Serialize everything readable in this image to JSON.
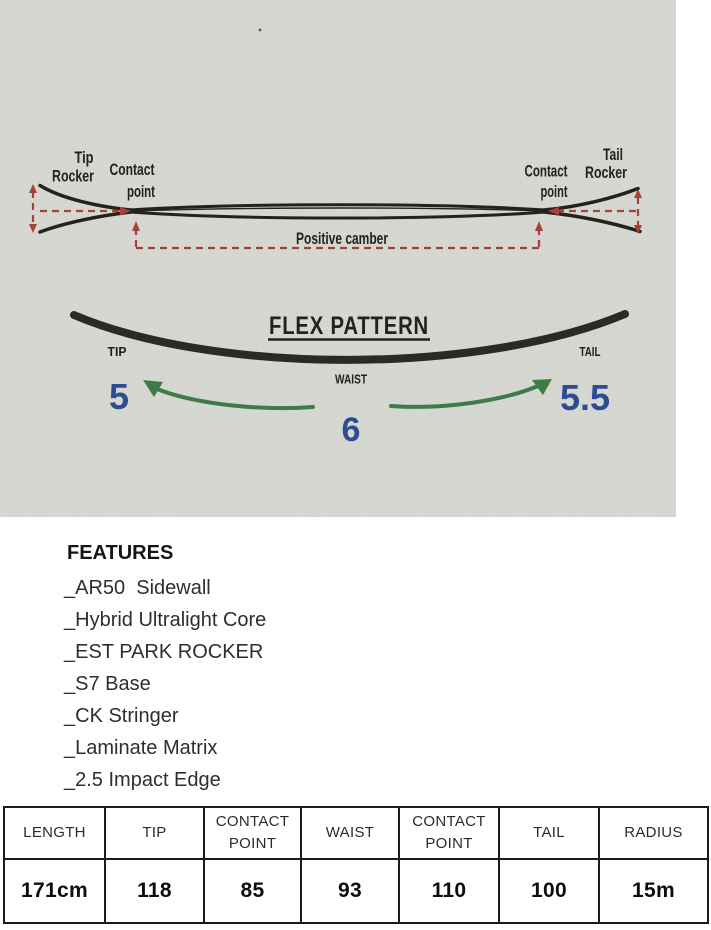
{
  "photo": {
    "camber": {
      "tip_rocker_line1": "Tip",
      "tip_rocker_line2": "Rocker",
      "contact_left_line1": "Contact",
      "contact_left_line2": "point",
      "positive_camber": "Positive camber",
      "contact_right_line1": "Contact",
      "contact_right_line2": "point",
      "tail_rocker_line1": "Tail",
      "tail_rocker_line2": "Rocker"
    },
    "flex": {
      "title": "FLEX PATTERN",
      "tip_label": "TIP",
      "tail_label": "TAIL",
      "waist_label": "WAIST",
      "tip_value": "5",
      "tail_value": "5.5",
      "waist_value": "6"
    },
    "colors": {
      "paper": "#d7d8d2",
      "ink_black": "#23221d",
      "annotation_red": "#a6413a",
      "flex_value_blue": "#2e4c90",
      "arrow_green": "#3e7b46"
    }
  },
  "features": {
    "heading": "FEATURES",
    "items": [
      "_AR50  Sidewall",
      "_Hybrid Ultralight Core",
      "_EST PARK ROCKER",
      "_S7 Base",
      "_CK Stringer",
      "_Laminate Matrix",
      "_2.5 Impact Edge"
    ]
  },
  "spec_table": {
    "headers": [
      "LENGTH",
      "TIP",
      "CONTACT POINT",
      "WAIST",
      "CONTACT POINT",
      "TAIL",
      "RADIUS"
    ],
    "values": [
      "171cm",
      "118",
      "85",
      "93",
      "110",
      "100",
      "15m"
    ]
  }
}
